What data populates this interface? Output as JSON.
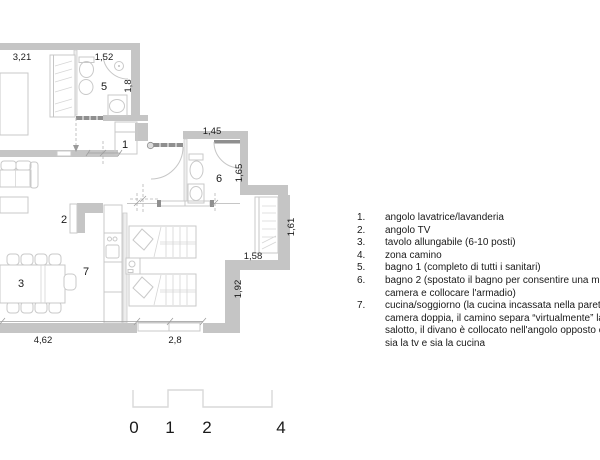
{
  "colors": {
    "wall": "#c5c5c5",
    "furniture_line": "#c9c9c9",
    "door_dark": "#8f8f8f",
    "text": "#1a1a1a",
    "scale_line": "#d9d9d9",
    "background": "#ffffff"
  },
  "plan": {
    "room_labels": [
      {
        "id": "5",
        "room": "bagno 1"
      },
      {
        "id": "1",
        "room": "angolo lavatrice/lavanderia"
      },
      {
        "id": "6",
        "room": "bagno 2"
      },
      {
        "id": "2",
        "room": "angolo TV"
      },
      {
        "id": "7",
        "room": "cucina/soggiorno"
      },
      {
        "id": "3",
        "room": "tavolo allungabile"
      }
    ],
    "dimensions": [
      {
        "label": "3,21"
      },
      {
        "label": "1,52"
      },
      {
        "label": "1,8"
      },
      {
        "label": "1,45"
      },
      {
        "label": "1,65"
      },
      {
        "label": "1,61"
      },
      {
        "label": "1,58"
      },
      {
        "label": "1,92"
      },
      {
        "label": "4,62"
      },
      {
        "label": "2,8"
      }
    ]
  },
  "legend": {
    "rows": [
      {
        "num": "1.",
        "text": "angolo lavatrice/lavanderia"
      },
      {
        "num": "2.",
        "text": "angolo TV"
      },
      {
        "num": "3.",
        "text": "tavolo allungabile (6-10 posti)"
      },
      {
        "num": "4.",
        "text": "zona camino"
      },
      {
        "num": "5.",
        "text": "bagno 1 (completo di tutti i sanitari)"
      },
      {
        "num": "6.",
        "text": "bagno 2 (spostato il bagno per consentire una migliore"
      },
      {
        "num": "",
        "text": "camera e collocare l'armadio)"
      },
      {
        "num": "7.",
        "text": "cucina/soggiorno (la cucina incassata nella parete della"
      },
      {
        "num": "",
        "text": "camera doppia, il camino separa “virtualmente” la zona"
      },
      {
        "num": "",
        "text": "salotto, il divano è collocato nell'angolo opposto con"
      },
      {
        "num": "",
        "text": "sia la tv e sia la cucina"
      }
    ]
  },
  "scale_bar": {
    "labels": [
      "0",
      "1",
      "2",
      "4"
    ]
  }
}
